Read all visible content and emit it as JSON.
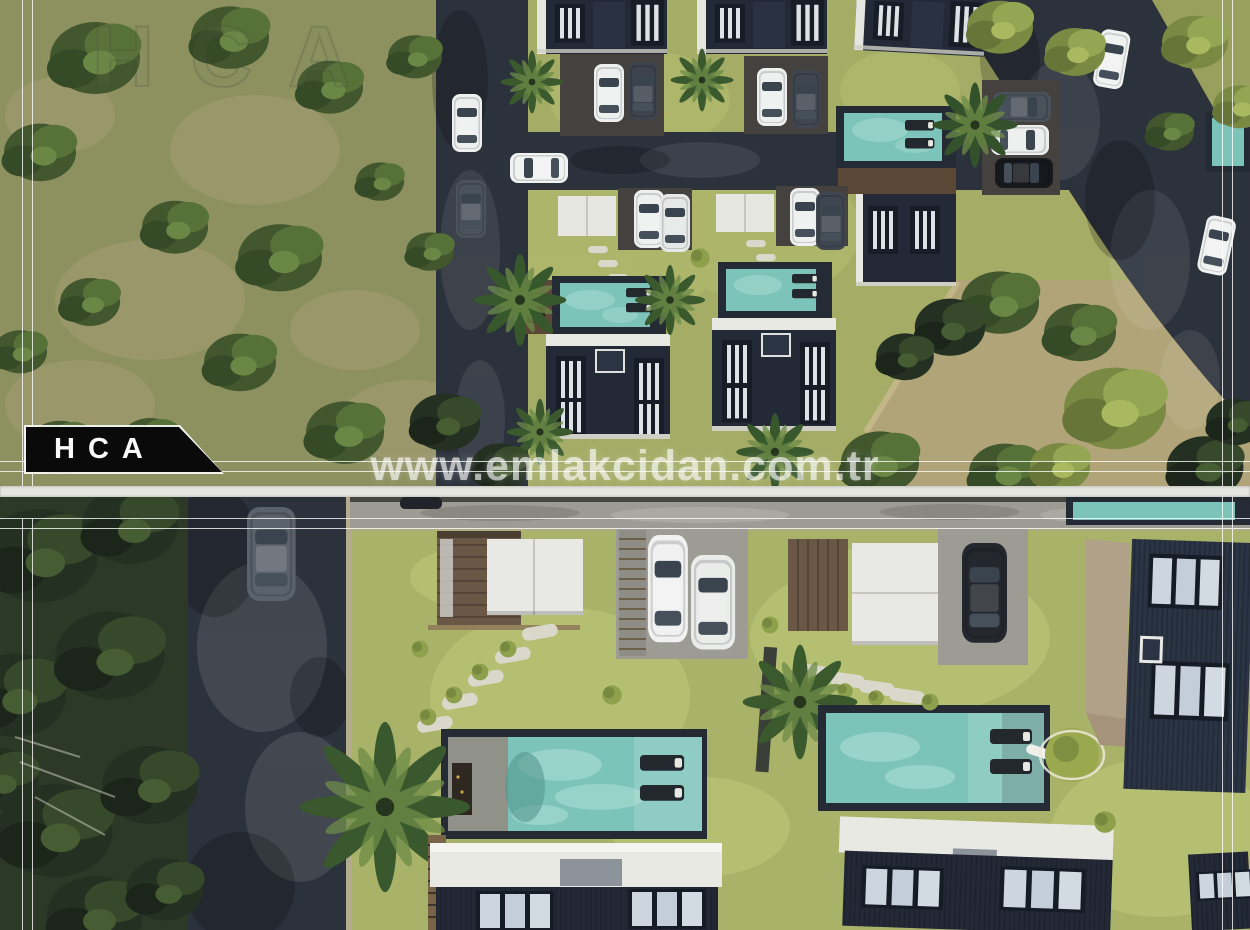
{
  "branding": {
    "logo_text": "HCA",
    "faint_watermark": "HCA",
    "site_watermark": "www.emlakcidan.com.tr"
  },
  "colors": {
    "lawn": "#a4ac66",
    "lawn2": "#a8b269",
    "field": "#8d9160",
    "dirt": "#b1a478",
    "asphalt": "#2c323c",
    "concrete": "#9c9c94",
    "pool": "#7cc4ba",
    "rim": "#242b35",
    "roof": "#232936",
    "trim": "#e9e9e4",
    "drive": "#45413e",
    "frame": "rgba(255,255,255,0.78)",
    "watermark": "rgba(255,255,255,0.62)",
    "logo-bg": "#0a0a0a",
    "logo-text-color": "#fafafa",
    "gap": "#e6e6e0",
    "trees-dark-zone": "#2d3927"
  }
}
